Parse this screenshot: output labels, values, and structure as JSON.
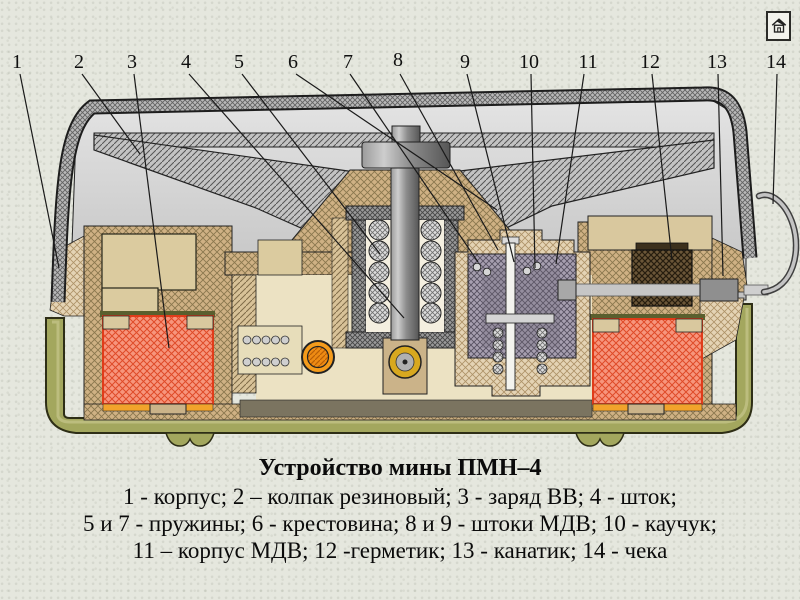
{
  "app": {
    "home_button": {
      "icon_name": "home-icon"
    }
  },
  "slide": {
    "title": "Устройство мины ПМН–4",
    "caption_lines": [
      "1 - корпус; 2 – колпак резиновый; 3 - заряд ВВ; 4 - шток;",
      "5 и 7 - пружины; 6 - крестовина; 8 и 9 - штоки МДВ; 10 - каучук;",
      "11 – корпус МДВ; 12 -герметик; 13 - канатик; 14 - чека"
    ]
  },
  "callouts": [
    {
      "num": "1",
      "part": "корпус"
    },
    {
      "num": "2",
      "part": "колпак резиновый"
    },
    {
      "num": "3",
      "part": "заряд ВВ"
    },
    {
      "num": "4",
      "part": "шток"
    },
    {
      "num": "5",
      "part": "пружина"
    },
    {
      "num": "6",
      "part": "крестовина"
    },
    {
      "num": "7",
      "part": "пружина"
    },
    {
      "num": "8",
      "part": "шток МДВ"
    },
    {
      "num": "9",
      "part": "шток МДВ"
    },
    {
      "num": "10",
      "part": "каучук"
    },
    {
      "num": "11",
      "part": "корпус МДВ"
    },
    {
      "num": "12",
      "part": "герметик"
    },
    {
      "num": "13",
      "part": "канатик"
    },
    {
      "num": "14",
      "part": "чека"
    }
  ],
  "colors": {
    "background": "#e5e7de",
    "body_tan": "#cfb184",
    "case_olive": "#a3a75e",
    "charge_red": "#f7957c",
    "charge_hatch": "#df4a28",
    "charge_border": "#e03c1a",
    "charge_strip_orange": "#f2a32b",
    "cap_gray": "#b9b9b9",
    "detonator_orange": "#f49b1b",
    "primer_gold": "#d8a81f",
    "mdv_violet_gray": "#a79fb0",
    "sealant_dark": "#6b5638"
  }
}
